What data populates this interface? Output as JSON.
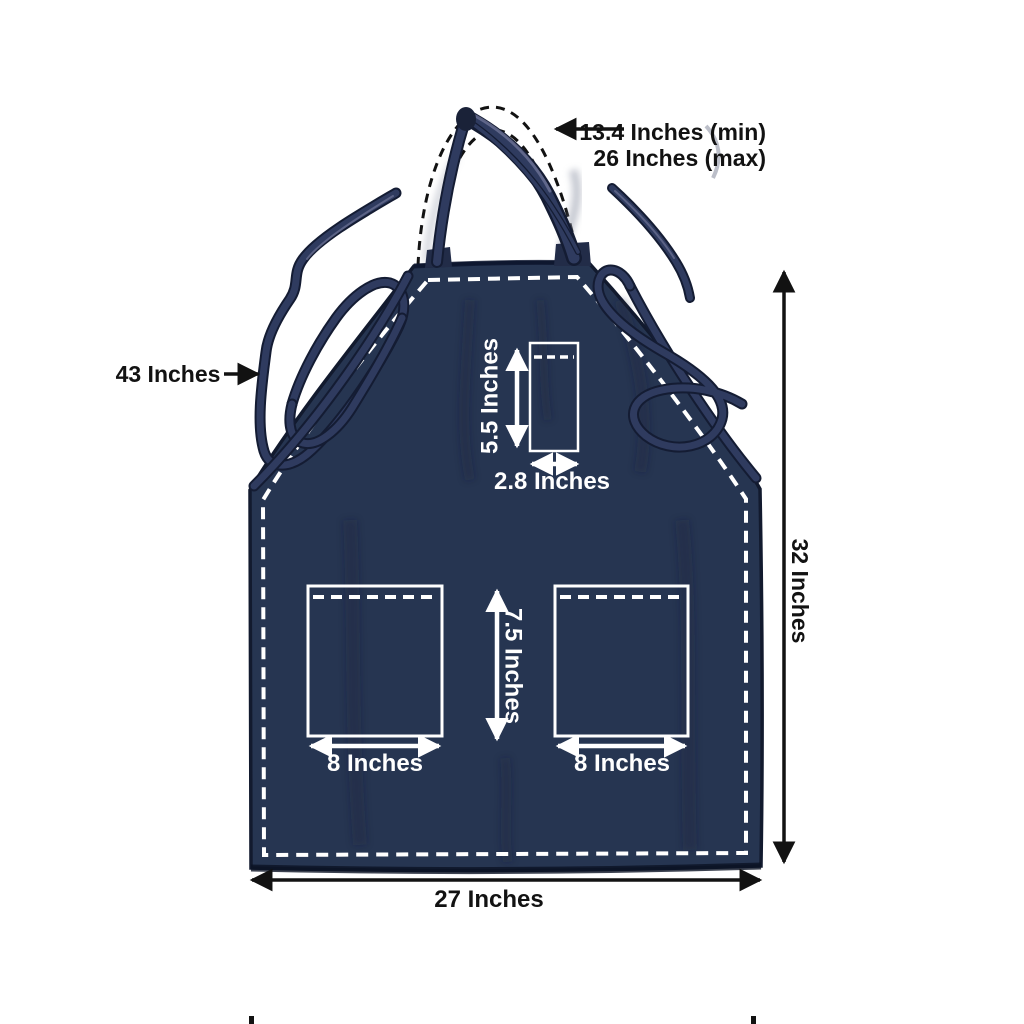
{
  "annotations": {
    "neck_min": "13.4 Inches (min)",
    "neck_max": "26 Inches (max)",
    "tie_length": "43 Inches",
    "apron_height": "32 Inches",
    "apron_width": "27 Inches",
    "chest_pocket_height": "5.5 Inches",
    "chest_pocket_width": "2.8 Inches",
    "lower_pocket_height": "7.5 Inches",
    "lower_pocket_left_width": "8 Inches",
    "lower_pocket_right_width": "8 Inches"
  },
  "colors": {
    "background": "#ffffff",
    "fabric": "#263551",
    "fabric_dark": "#14203a",
    "edge": "#121a2e",
    "strap": "#2f3b5f",
    "strap_outline": "#141c33",
    "strap_highlight": "#6d7396",
    "stitch_white": "#ffffff",
    "annotation_black": "#121212",
    "annotation_white": "#ffffff"
  }
}
